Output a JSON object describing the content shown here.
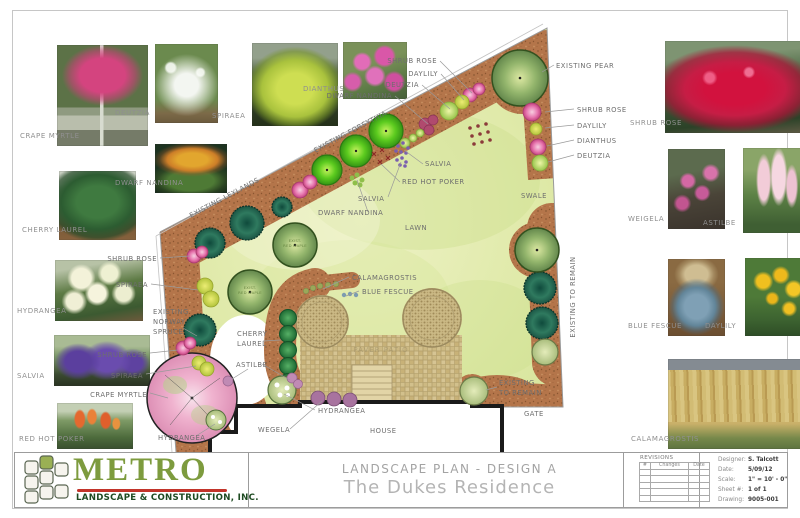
{
  "sheet": {
    "title_line1": "LANDSCAPE PLAN - DESIGN A",
    "title_line2": "The Dukes Residence",
    "logo": {
      "name": "METRO",
      "sub": "LANDSCAPE & CONSTRUCTION, INC."
    },
    "revisions": {
      "header": "REVISIONS",
      "cols": [
        "#",
        "Changes",
        "Date"
      ]
    },
    "info": [
      {
        "label": "Designer:",
        "value": "S. Talcott"
      },
      {
        "label": "Date:",
        "value": "5/09/12"
      },
      {
        "label": "Scale:",
        "value": "1\" = 10' - 0\""
      },
      {
        "label": "Sheet #:",
        "value": "1 of 1"
      },
      {
        "label": "Drawing:",
        "value": "9005-001"
      }
    ],
    "colors": {
      "metro_green": "#7d9b3e",
      "metro_dark_green": "#1d4a21",
      "underline_red": "#c2342a",
      "mulch": "#b4754a",
      "lawn": "#dfe9ac",
      "paver": "#d8c795"
    }
  },
  "photos": {
    "crape_myrtle": "CRAPE MYRTLE",
    "deutzia": "DEUTZIA",
    "spiraea": "SPIRAEA",
    "dianthus": "DIANTHUS",
    "dwarf_nandina": "DWARF NANDINA",
    "cherry_laurel": "CHERRY LAUREL",
    "hydrangea": "HYDRANGEA",
    "salvia": "SALVIA",
    "red_hot_poker": "RED HOT POKER",
    "shrub_rose": "SHRUB ROSE",
    "weigela": "WEIGELA",
    "astilbe": "ASTILBE",
    "blue_fescue": "BLUE FESCUE",
    "daylily": "DAYLILY",
    "calamagrostis": "CALAMAGROSTIS"
  },
  "plan": {
    "callouts": {
      "shrub_rose_top": "SHRUB ROSE",
      "daylily_top": "DAYLILY",
      "deutzia_top": "DEUTZIA",
      "dwarf_nandina_top": "DWARF NANDINA",
      "existing_pear": "EXISTING PEAR",
      "shrub_rose_right": "SHRUB ROSE",
      "daylily_right": "DAYLILY",
      "dianthus_right": "DIANTHUS",
      "deutzia_right": "DEUTZIA",
      "existing_forsythia": "EXISTING FORSYTHIA",
      "existing_leylands": "EXISTING LEYLANDS",
      "salvia_1": "SALVIA",
      "red_hot_poker": "RED HOT POKER",
      "salvia_2": "SALVIA",
      "dwarf_nandina_2": "DWARF NANDINA",
      "lawn": "LAWN",
      "swale": "SWALE",
      "existing_to_remain_edge": "EXISTING TO REMAIN",
      "calamagrostis": "CALAMAGROSTIS",
      "blue_fescue": "BLUE FESCUE",
      "cherry_1": "CHERRY",
      "cherry_2": "LAUREL",
      "astilbe": "ASTILBE",
      "hydrangea_mid": "HYDRANGEA",
      "wegela": "WEGELA",
      "house": "HOUSE",
      "existing_remain_1": "EXISTING",
      "existing_remain_2": "TO REMAIN",
      "gate": "GATE",
      "shrub_rose_l1": "SHRUB ROSE",
      "spiraea_l1": "SPIRAEA",
      "norway_1": "EXISTING",
      "norway_2": "NORWAY",
      "norway_3": "SPRUCE",
      "shrub_rose_l2": "SHRUB ROSE",
      "spiraea_l2": "SPIRAEA",
      "crape_myrtle_l": "CRAPE MYRTLE",
      "hydrangea_bl": "HYDRANGEA",
      "paver_patio": "PAVER PATIO",
      "maple1_a": "EXIST.",
      "maple1_b": "RED MAPLE",
      "maple2_a": "EXIST.",
      "maple2_b": "RED MAPLE"
    }
  }
}
